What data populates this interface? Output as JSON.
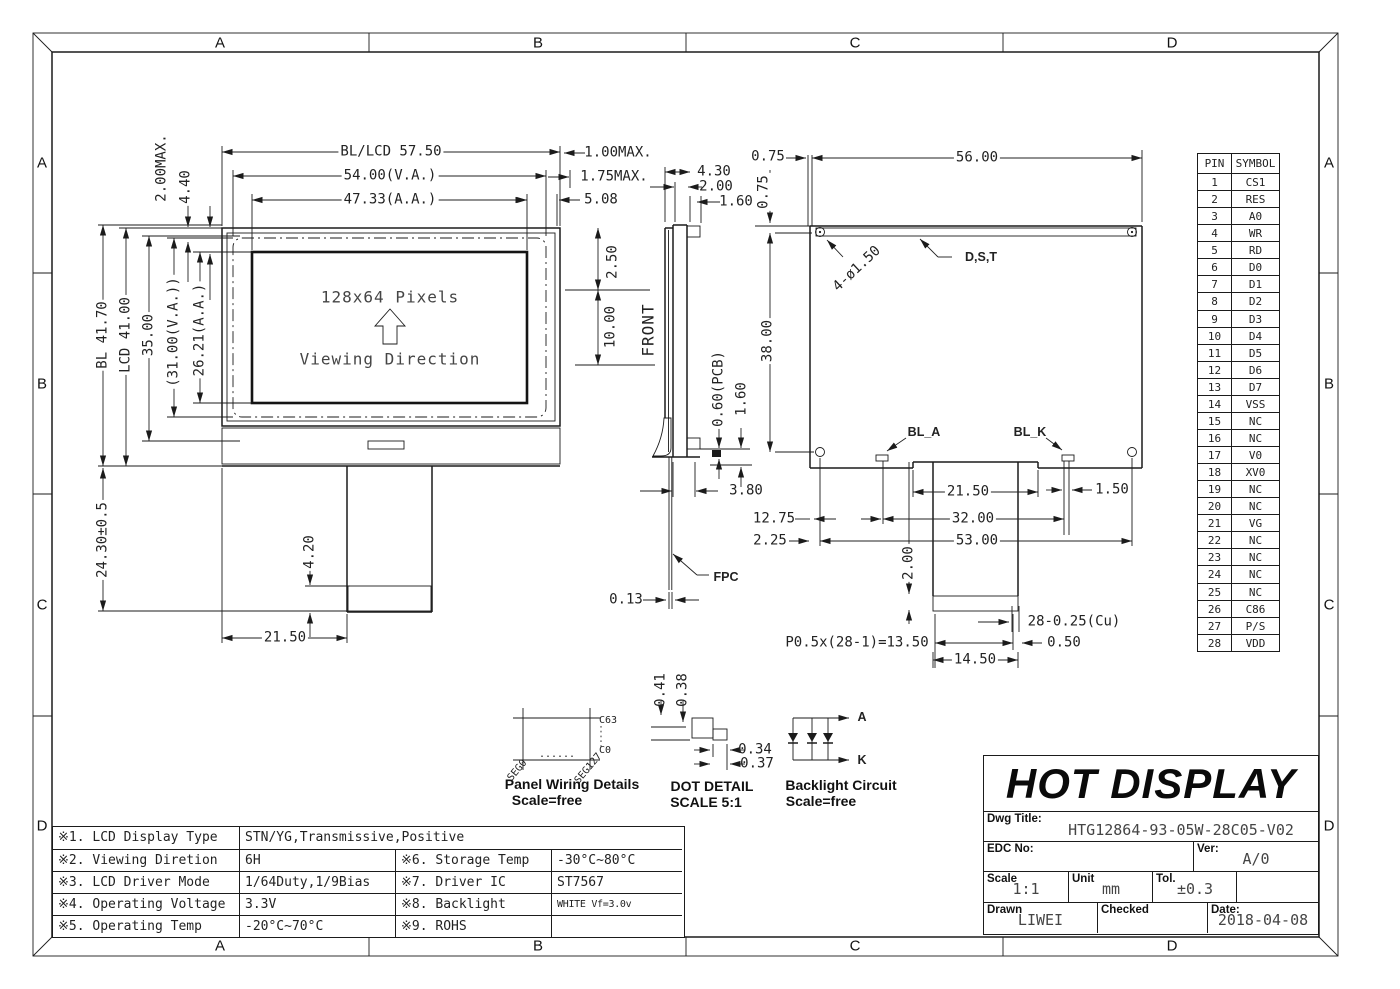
{
  "frame": {
    "zones": [
      "A",
      "B",
      "C",
      "D"
    ]
  },
  "front_view": {
    "pixels_label": "128x64 Pixels",
    "viewing_label": "Viewing Direction",
    "dims": {
      "overall_w": "BL/LCD 57.50",
      "va_w": "54.00(V.A.)",
      "aa_w": "47.33(A.A.)",
      "bezel_max": "2.00MAX.",
      "d440": "4.40",
      "bl_h": "BL 41.70",
      "lcd_h": "LCD 41.00",
      "d3500": "35.00",
      "va_h": "(31.00(V.A.))",
      "aa_h": "26.21(A.A.)",
      "fpc_len": "24.30±0.5",
      "d420": "4.20",
      "d2150": "21.50",
      "max100": "1.00MAX.",
      "max175": "1.75MAX.",
      "d508": "5.08",
      "d250": "2.50",
      "d1000": "10.00"
    }
  },
  "side_view": {
    "front_label": "FRONT",
    "fpc_label": "FPC",
    "dims": {
      "d430": "4.30",
      "d200": "2.00",
      "d160": "1.60",
      "pcb": "0.60(PCB)",
      "d160b": "1.60",
      "d380": "3.80",
      "d013": "0.13"
    }
  },
  "back_view": {
    "labels": {
      "holes": "4-ø1.50",
      "dst": "D,S,T",
      "bla": "BL_A",
      "blk": "BL_K"
    },
    "dims": {
      "d075h": "0.75",
      "d075v": "0.75",
      "d5600": "56.00",
      "d3800": "38.00",
      "d2150": "21.50",
      "d150": "1.50",
      "d1275": "12.75",
      "d3200": "32.00",
      "d225": "2.25",
      "d5300": "53.00",
      "d200": "2.00",
      "cu": "28-0.25(Cu)",
      "pitch": "P0.5x(28-1)=13.50",
      "d050": "0.50",
      "d1450": "14.50"
    }
  },
  "details": {
    "panel": {
      "title": "Panel Wiring Details",
      "scale": "Scale=free",
      "c63": "C63",
      "c0": "C0",
      "seg0": "SEG0",
      "seg127": "SEG127",
      "dots": "......"
    },
    "dot": {
      "title": "DOT DETAIL",
      "scale": "SCALE 5:1",
      "d041": "0.41",
      "d038": "0.38",
      "d034": "0.34",
      "d037": "0.37"
    },
    "backlight": {
      "title": "Backlight Circuit",
      "scale": "Scale=free",
      "a": "A",
      "k": "K"
    }
  },
  "pin_table": {
    "headers": [
      "PIN",
      "SYMBOL"
    ],
    "rows": [
      {
        "pin": "1",
        "symbol": "CS1"
      },
      {
        "pin": "2",
        "symbol": "RES"
      },
      {
        "pin": "3",
        "symbol": "A0"
      },
      {
        "pin": "4",
        "symbol": "WR"
      },
      {
        "pin": "5",
        "symbol": "RD"
      },
      {
        "pin": "6",
        "symbol": "D0"
      },
      {
        "pin": "7",
        "symbol": "D1"
      },
      {
        "pin": "8",
        "symbol": "D2"
      },
      {
        "pin": "9",
        "symbol": "D3"
      },
      {
        "pin": "10",
        "symbol": "D4"
      },
      {
        "pin": "11",
        "symbol": "D5"
      },
      {
        "pin": "12",
        "symbol": "D6"
      },
      {
        "pin": "13",
        "symbol": "D7"
      },
      {
        "pin": "14",
        "symbol": "VSS"
      },
      {
        "pin": "15",
        "symbol": "NC"
      },
      {
        "pin": "16",
        "symbol": "NC"
      },
      {
        "pin": "17",
        "symbol": "V0"
      },
      {
        "pin": "18",
        "symbol": "XV0"
      },
      {
        "pin": "19",
        "symbol": "NC"
      },
      {
        "pin": "20",
        "symbol": "NC"
      },
      {
        "pin": "21",
        "symbol": "VG"
      },
      {
        "pin": "22",
        "symbol": "NC"
      },
      {
        "pin": "23",
        "symbol": "NC"
      },
      {
        "pin": "24",
        "symbol": "NC"
      },
      {
        "pin": "25",
        "symbol": "NC"
      },
      {
        "pin": "26",
        "symbol": "C86"
      },
      {
        "pin": "27",
        "symbol": "P/S"
      },
      {
        "pin": "28",
        "symbol": "VDD"
      }
    ]
  },
  "spec_table": {
    "r1k": "※1. LCD Display Type",
    "r1v": "STN/YG,Transmissive,Positive",
    "r2k": "※2. Viewing Diretion",
    "r2v": "6H",
    "r2k2": "※6. Storage Temp",
    "r2v2": "-30°C~80°C",
    "r3k": "※3. LCD Driver Mode",
    "r3v": "1/64Duty,1/9Bias",
    "r3k2": "※7. Driver IC",
    "r3v2": "ST7567",
    "r4k": "※4. Operating Voltage",
    "r4v": "3.3V",
    "r4k2": "※8. Backlight",
    "r4v2": "WHITE Vf=3.0v IF=45mA",
    "r5k": "※5. Operating Temp",
    "r5v": "-20°C~70°C",
    "r5k2": "※9. ROHS",
    "r5v2": ""
  },
  "title_block": {
    "company": "HOT DISPLAY",
    "dwg_title_label": "Dwg Title:",
    "dwg_title": "HTG12864-93-05W-28C05-V02",
    "edc_label": "EDC No:",
    "edc": "",
    "ver_label": "Ver:",
    "ver": "A/0",
    "scale_label": "Scale",
    "scale": "1:1",
    "unit_label": "Unit",
    "unit": "mm",
    "tol_label": "Tol.",
    "tol": "±0.3",
    "drawn_label": "Drawn",
    "drawn": "LIWEI",
    "checked_label": "Checked",
    "checked": "",
    "date_label": "Date:",
    "date": "2018-04-08"
  }
}
